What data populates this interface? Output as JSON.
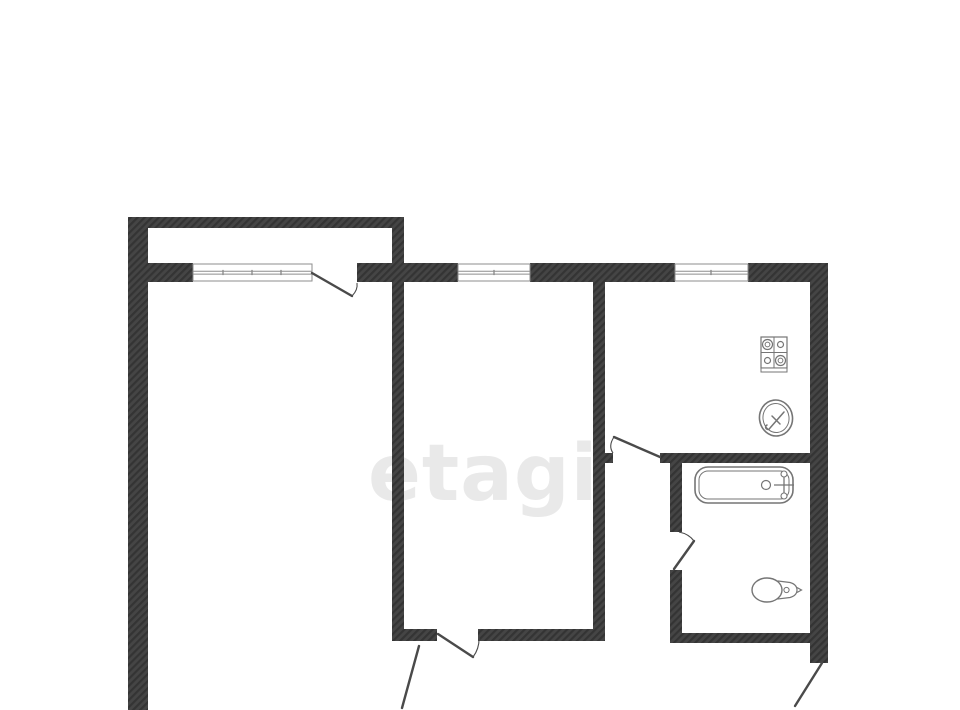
{
  "canvas": {
    "width": 960,
    "height": 710,
    "background": "#ffffff"
  },
  "palette": {
    "wall_hatch_dark": "#343434",
    "wall_hatch_light": "#454545",
    "door_line": "#4a4a4a",
    "window_line": "#8d8d8d",
    "fixture_line": "#757575",
    "watermark_color": "#e9e9e9"
  },
  "watermark": {
    "text": "etagi",
    "x": 368,
    "y": 500,
    "font_size": 78
  },
  "walls": [
    {
      "name": "wall-balcony-front",
      "x": 128,
      "y": 217,
      "w": 276,
      "h": 11
    },
    {
      "name": "wall-exterior-left",
      "x": 128,
      "y": 217,
      "w": 20,
      "h": 493
    },
    {
      "name": "wall-facade-left-of-balcony-window",
      "x": 148,
      "y": 263,
      "w": 45,
      "h": 19
    },
    {
      "name": "wall-facade-balcony-door-to-room-window",
      "x": 357,
      "y": 263,
      "w": 101,
      "h": 19
    },
    {
      "name": "wall-facade-room-window-to-kitchen-window",
      "x": 530,
      "y": 263,
      "w": 145,
      "h": 19
    },
    {
      "name": "wall-facade-right-of-kitchen-window",
      "x": 748,
      "y": 263,
      "w": 80,
      "h": 19
    },
    {
      "name": "wall-exterior-right",
      "x": 810,
      "y": 263,
      "w": 18,
      "h": 400
    },
    {
      "name": "wall-living-room-divider",
      "x": 392,
      "y": 217,
      "w": 12,
      "h": 423
    },
    {
      "name": "wall-middle-room-right",
      "x": 593,
      "y": 282,
      "w": 12,
      "h": 358
    },
    {
      "name": "wall-kitchen-door-stub",
      "x": 593,
      "y": 453,
      "w": 20,
      "h": 10
    },
    {
      "name": "wall-bathroom-top",
      "x": 660,
      "y": 453,
      "w": 150,
      "h": 10
    },
    {
      "name": "wall-bathroom-left-upper",
      "x": 670,
      "y": 463,
      "w": 12,
      "h": 69
    },
    {
      "name": "wall-bathroom-left-lower",
      "x": 670,
      "y": 570,
      "w": 12,
      "h": 73
    },
    {
      "name": "wall-bathroom-bottom",
      "x": 670,
      "y": 633,
      "w": 140,
      "h": 10
    },
    {
      "name": "wall-middle-room-bottom-left",
      "x": 392,
      "y": 629,
      "w": 45,
      "h": 12
    },
    {
      "name": "wall-middle-room-bottom-right",
      "x": 478,
      "y": 629,
      "w": 127,
      "h": 12
    }
  ],
  "windows": [
    {
      "name": "balcony-window",
      "x": 193,
      "y": 264,
      "w": 119,
      "h": 17,
      "ticks": [
        223,
        252,
        281
      ]
    },
    {
      "name": "middle-room-window",
      "x": 458,
      "y": 264,
      "w": 72,
      "h": 17,
      "ticks": [
        494
      ]
    },
    {
      "name": "kitchen-window",
      "x": 675,
      "y": 264,
      "w": 73,
      "h": 17,
      "ticks": [
        711
      ]
    }
  ],
  "doors": [
    {
      "name": "balcony-door",
      "leaf": "M312 273 L352 296",
      "arc": "M352 296 Q358 290 357 283"
    },
    {
      "name": "kitchen-door",
      "leaf": "M660 457 L614 437",
      "arc": "M614 437 Q608 446 613 453"
    },
    {
      "name": "bathroom-door",
      "leaf": "M674 569 L694 541",
      "arc": "M694 541 Q689 534 679 532"
    },
    {
      "name": "middle-room-door",
      "leaf": "M438 634 L473 657",
      "arc": "M473 657 Q480 648 479 635"
    },
    {
      "name": "living-room-door-leaf",
      "leaf": "M419 646 L402 708"
    },
    {
      "name": "entrance-door-leaf",
      "leaf": "M822 663 L795 706"
    }
  ],
  "fixtures": {
    "stove": {
      "x": 761,
      "y": 337,
      "w": 26,
      "h": 31,
      "base_h": 4,
      "burners": [
        {
          "cx": 767.5,
          "cy": 344.5,
          "r": 5,
          "ir": 2.4
        },
        {
          "cx": 780.5,
          "cy": 344.5,
          "r": 3,
          "ir": 0
        },
        {
          "cx": 767.5,
          "cy": 360.5,
          "r": 3,
          "ir": 0
        },
        {
          "cx": 780.5,
          "cy": 360.5,
          "r": 5,
          "ir": 2.4
        }
      ]
    },
    "sink": {
      "cx": 776,
      "cy": 418,
      "r_outer": 16.5,
      "r_inner": 13,
      "faucet": "M770 428 L784 412 M772 416 L780 424 M770 428 a2.3 2.3 0 1 1 -3 -3"
    },
    "bathtub": {
      "x": 695,
      "y": 467,
      "w": 98,
      "h": 36,
      "rx": 13,
      "inset": 4,
      "drain": {
        "cx": 766,
        "cy": 485,
        "r": 4.5
      },
      "faucet": {
        "x": 784,
        "y1": 472,
        "y2": 498,
        "bar_x1": 774,
        "bar_x2": 794,
        "bar_y": 485,
        "knob_r": 3
      }
    },
    "toilet": {
      "bowl": {
        "cx": 767,
        "cy": 590,
        "rx": 15,
        "ry": 12
      },
      "tank": "M778 581 L790 582.5 Q797 584.5 797 590 Q797 595.5 790 597.5 L778 599 Z",
      "button": {
        "cx": 786.5,
        "cy": 590,
        "r": 2.6
      },
      "nub": "M797 587.5 L801.5 590 L797 592.5"
    }
  }
}
